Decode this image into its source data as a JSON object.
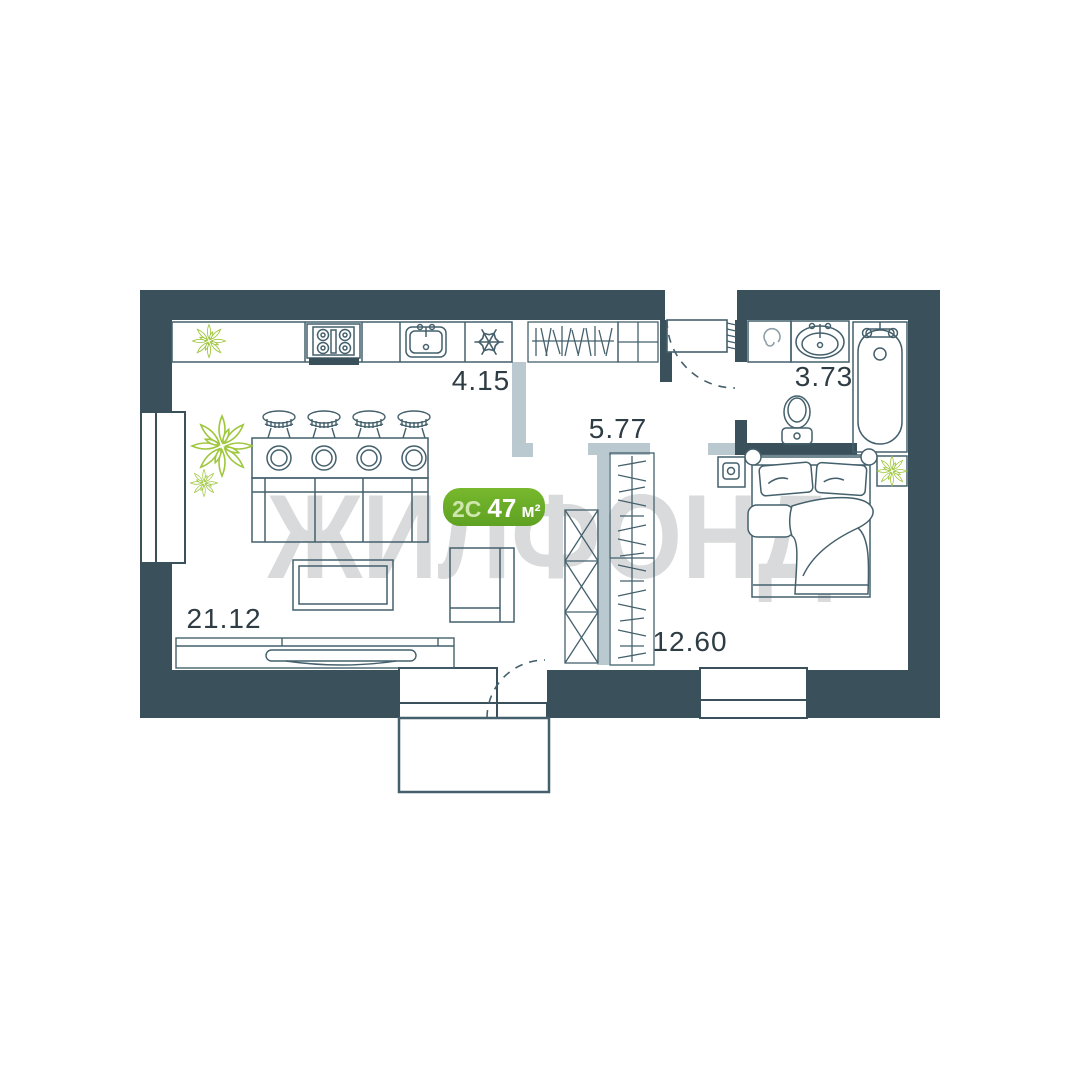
{
  "plan": {
    "watermark": "ЖИЛФОНД",
    "badge": {
      "type": "2С",
      "area": "47",
      "unit": "м²"
    },
    "rooms": [
      {
        "id": "living-kitchen",
        "area": "21.12"
      },
      {
        "id": "kitchen-zone",
        "area": "4.15"
      },
      {
        "id": "hallway",
        "area": "5.77"
      },
      {
        "id": "bedroom",
        "area": "12.60"
      },
      {
        "id": "bathroom",
        "area": "3.73"
      }
    ],
    "colors": {
      "wall": "#3a515c",
      "furniture_line": "#44606c",
      "light_partition": "#bac8cf",
      "plant_green": "#9fc73e",
      "badge_green_top": "#77b82e",
      "badge_green_bottom": "#5fa122",
      "watermark_gray": "#d9dadb",
      "label_text": "#2e3c44"
    },
    "icons": {
      "plant-icon": "radial-leaf plant",
      "stove-icon": "4-burner cooktop",
      "kitchen-sink-icon": "sink with faucet",
      "snowflake-icon": "fridge/freezer snowflake",
      "hangers-icon": "wardrobe hanger strokes",
      "washing-machine-icon": "spiral drum",
      "bath-sink-icon": "oval basin with taps",
      "bathtub-icon": "tub with faucet",
      "toilet-icon": "toilet bowl and tank",
      "bed-icon": "double bed with pillows and duvet",
      "tv-icon": "TV on long stand",
      "door-arc-icon": "door swing arc"
    }
  }
}
